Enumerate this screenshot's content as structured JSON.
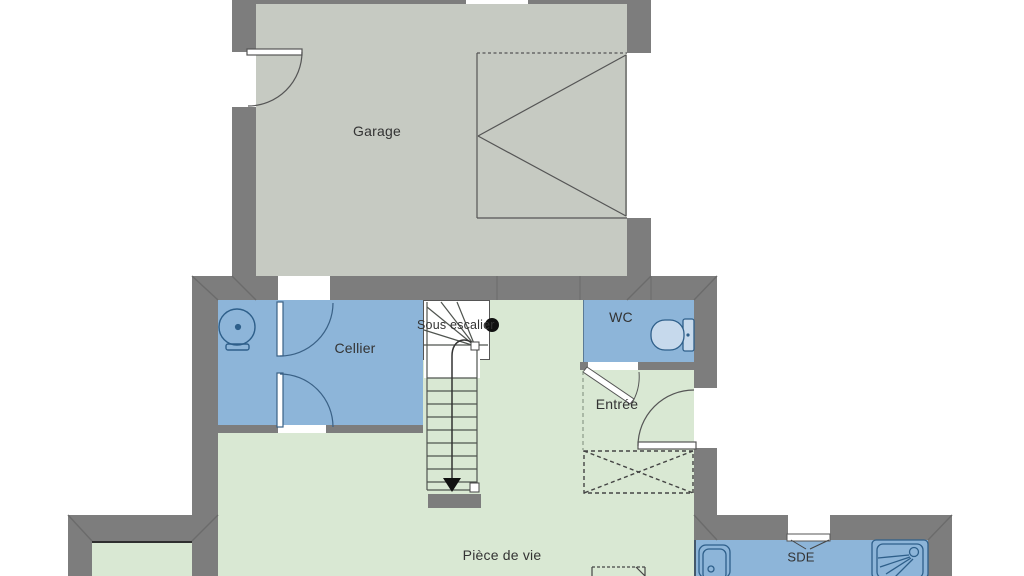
{
  "plan": {
    "labels": {
      "garage": "Garage",
      "cellier": "Cellier",
      "sous_escalier": "Sous escalier",
      "wc": "WC",
      "entree": "Entrée",
      "piece_de_vie": "Pièce de vie",
      "sde": "SDE"
    },
    "colors": {
      "wall": "#7d7d7d",
      "wall_joint": "#6b6b6b",
      "garage_floor": "#c6cac2",
      "living_floor": "#d9e8d3",
      "wet_room_floor": "#8db5d9",
      "fixture_outline": "#2e5f8a",
      "fixture_fill": "#c6d9ec",
      "linework": "#4f544f",
      "text": "#333333",
      "stair_marker": "#111111"
    }
  }
}
